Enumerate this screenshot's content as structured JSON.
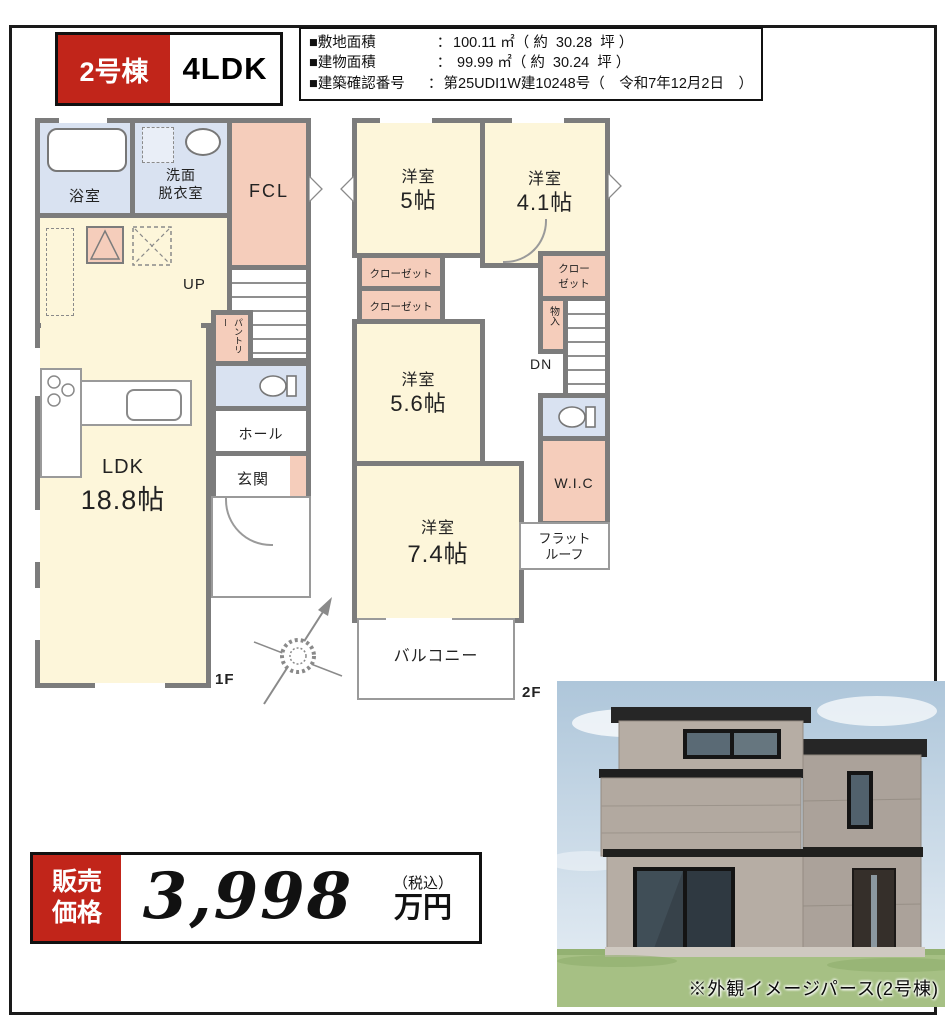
{
  "badge": {
    "building": "2号棟",
    "layout": "4LDK"
  },
  "info": {
    "rows": [
      {
        "label": "■敷地面積",
        "colon": "：",
        "value": "100.11 ㎡（ 約  30.28  坪 ）"
      },
      {
        "label": "■建物面積",
        "colon": "：",
        "value": " 99.99 ㎡（ 約  30.24  坪 ）"
      },
      {
        "label": "■建築確認番号",
        "colon": "：",
        "value": "第25UDI1W建10248号（　令和7年12月2日　）"
      }
    ]
  },
  "floor1": {
    "floor_label": "1F",
    "up": "UP",
    "rooms": {
      "bath": "浴室",
      "washroom_line1": "洗面",
      "washroom_line2": "脱衣室",
      "fcl": "FCL",
      "pantry": "パントリー",
      "hall": "ホール",
      "genkan": "玄関",
      "ldk_line1": "LDK",
      "ldk_line2": "18.8帖"
    }
  },
  "floor2": {
    "floor_label": "2F",
    "dn": "DN",
    "rooms": {
      "room5_line1": "洋室",
      "room5_line2": "5帖",
      "room41_line1": "洋室",
      "room41_line2": "4.1帖",
      "closet_a": "クローゼット",
      "closet_b": "クローゼット",
      "closet_c_line1": "クロー",
      "closet_c_line2": "ゼット",
      "storage": "物入",
      "room56_line1": "洋室",
      "room56_line2": "5.6帖",
      "wic": "W.I.C",
      "room74_line1": "洋室",
      "room74_line2": "7.4帖",
      "flatroof_line1": "フラット",
      "flatroof_line2": "ルーフ",
      "balcony": "バルコニー"
    }
  },
  "price": {
    "label_line1": "販売",
    "label_line2": "価格",
    "amount": "3,998",
    "tax_note": "（税込）",
    "unit": "万円"
  },
  "render_caption": "※外観イメージパース(2号棟)",
  "colors": {
    "accent_red": "#c1251a",
    "room_cream": "#fdf6da",
    "wet_area_blue": "#d9e2f1",
    "closet_pink": "#f5cdbb",
    "wall_gray": "#7c7c7c"
  }
}
